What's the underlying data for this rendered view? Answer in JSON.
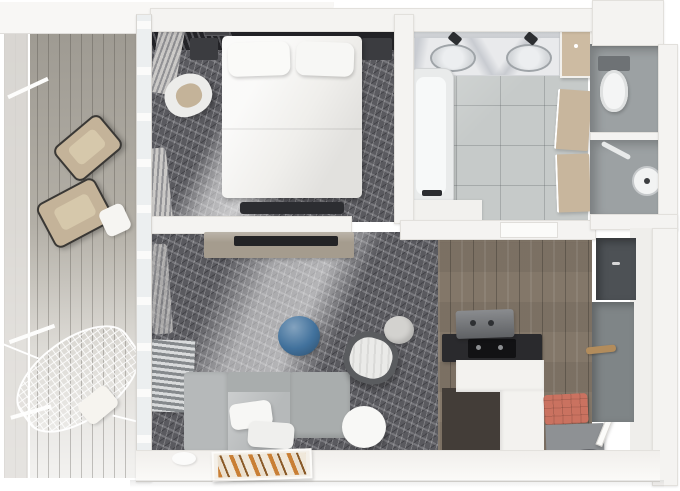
{
  "scene": {
    "type": "3d-floor-plan-top-view",
    "description": "Top-down 3D cutaway render of a one-bedroom suite with balcony, bedroom, living room, kitchenette, bathroom, WC, shower room and entry hall",
    "rooms": [
      {
        "id": "balcony",
        "name": "Balcony",
        "furniture": [
          "lounge-chair",
          "lounge-chair",
          "side-table",
          "hammock",
          "hammock-pillow"
        ]
      },
      {
        "id": "bedroom",
        "name": "Bedroom",
        "furniture": [
          "double-bed",
          "pillow-left",
          "pillow-right",
          "nightstand-left",
          "nightstand-right",
          "corner-armchair",
          "foot-bench"
        ]
      },
      {
        "id": "living-room",
        "name": "Living Room",
        "furniture": [
          "corner-sofa",
          "sofa-pillows",
          "blue-pouf",
          "swivel-armchair",
          "small-stool",
          "coffee-table",
          "radiator",
          "tv-console",
          "tv",
          "wall-artwork"
        ]
      },
      {
        "id": "bathroom",
        "name": "Bathroom",
        "furniture": [
          "double-sink-vanity",
          "bathtub",
          "shower-doors",
          "storage-closet"
        ]
      },
      {
        "id": "wc",
        "name": "WC",
        "furniture": [
          "toilet"
        ]
      },
      {
        "id": "shower-room",
        "name": "Shower Room",
        "furniture": [
          "shower-stool",
          "grab-bar"
        ]
      },
      {
        "id": "kitchen",
        "name": "Kitchenette",
        "furniture": [
          "counter",
          "cooktop",
          "coffee-machine",
          "base-cabinet"
        ]
      },
      {
        "id": "entry",
        "name": "Entry Hall",
        "furniture": [
          "coral-bench",
          "shoe-cabinet",
          "door-mat",
          "wardrobe",
          "coat-rod",
          "entry-door"
        ]
      }
    ]
  },
  "palette": {
    "background": "#ffffff",
    "wall": "#f4f3f1",
    "carpet_gray": "#5a5a5f",
    "deck_wood": "#c2beb5",
    "kitchen_wood": "#837769",
    "bathroom_tile": "#c6cac9",
    "wc_tile": "#9ca1a3",
    "marble": "#e9eaec",
    "dark_wall": "#232327",
    "bed_white": "#f0efec",
    "sofa_gray": "#b6b9ba",
    "chaise_gray": "#a9adad",
    "pouf_blue": "#41719c",
    "bench_coral": "#ca7260",
    "lounge_tan": "#c4b399",
    "console_wood": "#a59c8e",
    "wardrobe_gray": "#7f8587",
    "rod_wood": "#b28c5c",
    "art_orange": "#c97f35"
  }
}
